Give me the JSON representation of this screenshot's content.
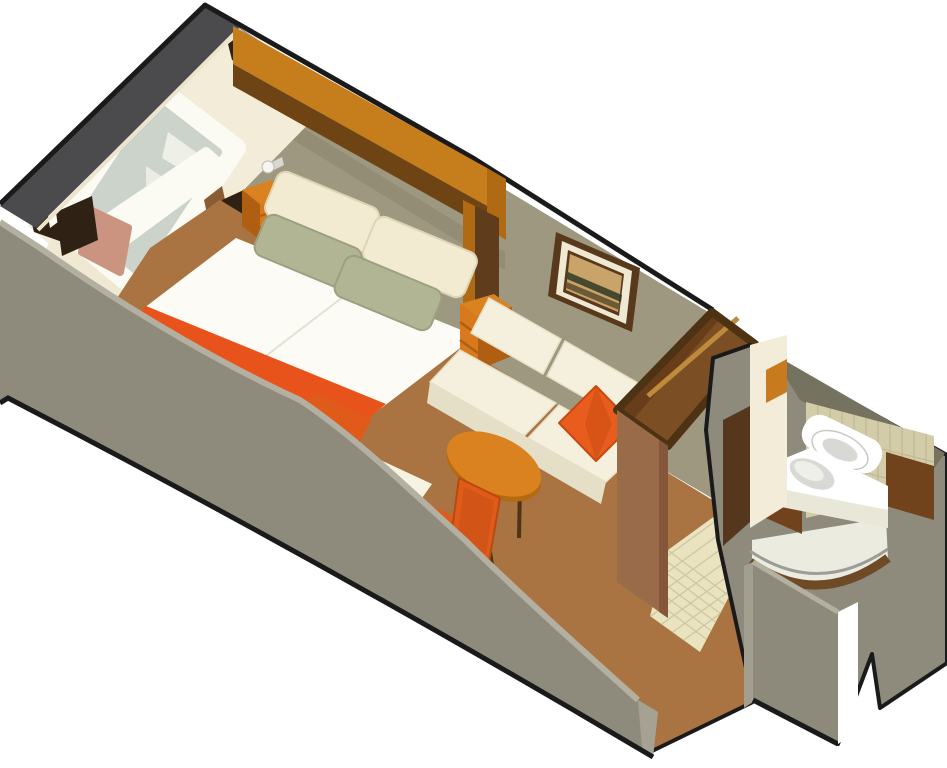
{
  "scene": {
    "type": "isometric-cutaway-floorplan",
    "subject": "Cruise ship oceanview stateroom - isometric cutaway floor plan",
    "areas": [
      "sleeping-area",
      "sitting-area",
      "entry-corridor",
      "bathroom"
    ],
    "objects": [
      "exterior-hull-wall",
      "picture-window",
      "window-curtains",
      "window-seat",
      "headboard-canopy",
      "double-bed",
      "bed-runner",
      "pillows",
      "nightstand-left",
      "nightstand-right",
      "wall-lamp",
      "framed-picture",
      "sofa",
      "throw-pillow",
      "coffee-table",
      "desk",
      "desk-stool",
      "chair",
      "wardrobe",
      "bathroom-sink",
      "toilet",
      "shower",
      "vanity",
      "bathroom-door",
      "tile-floor",
      "carpet",
      "cutaway-front-wall"
    ]
  },
  "palette": {
    "bg": "#ffffff",
    "outline": "#1a1a1a",
    "hullDark": "#4b4b4d",
    "wallOlive": "#9d987f",
    "wallOliveShadow": "#8a8570",
    "swooshGray": "#8e8b7c",
    "swooshLight": "#b3b0a1",
    "swooshEnd": "#a5a294",
    "creamWall": "#f2ecd9",
    "creamTrim": "#ece4cc",
    "canopyOrange": "#c67d1c",
    "canopyShelf": "#6f4415",
    "postOrange": "#b06a14",
    "postDark": "#5f3c1c",
    "woodTrim": "#8a5c33",
    "curtain": "#2f2214",
    "windowFrame": "#fbfaf3",
    "glass": "#ccd3cb",
    "glassShape": "#eef0e8",
    "seatPink": "#cb9480",
    "sillCream": "#efe8d2",
    "bedBase": "#4a2d12",
    "duvet": "#fcfbf5",
    "duvetShade": "#e9e6d8",
    "runnerOrange": "#e7531b",
    "runnerDark": "#c44312",
    "pillowCream": "#f2ebd1",
    "pillowCreamShade": "#ded5b5",
    "pillowSage": "#b2b594",
    "pillowSageShade": "#9ba080",
    "sofaCream": "#f5f0dd",
    "sofaShade": "#e6dfc7",
    "sofaDark": "#d7cfb2",
    "throwOrange": "#e85d1d",
    "throwDark": "#c8490f",
    "nightOrange": "#d8791d",
    "nightShade": "#b05f12",
    "tableOrange": "#d9821f",
    "tableRim": "#b36a10",
    "legDark": "#4d3318",
    "chairOrange": "#e05a1a",
    "chairDark": "#b84a10",
    "deskWhite": "#f7f3e3",
    "deskShade": "#e8e2cc",
    "carpet": "#a97441",
    "tile": "#eae3c0",
    "tileGrid": "#cfc79f",
    "wardrobeRim": "#4e3214",
    "wardrobeInterior": "#7c4e24",
    "wardrobeInteriorDark": "#653c19",
    "wardrobeFront": "#9a6b48",
    "wardrobeFrontDark": "#84563a",
    "rail": "#c08a3c",
    "bathGrayDark": "#75725f",
    "bathTile": "#d3cca8",
    "bathTileGrid": "#bdb58e",
    "vanityBrown": "#71431d",
    "fixtureWhite": "#ffffff",
    "fixtureShade": "#d8d8d4",
    "showerFloor": "#ecebdf",
    "showerCurve": "#6e4a26",
    "showerRail": "#9c9c98",
    "bathDoorOrange": "#c87a1e",
    "corridorDark": "#54371c",
    "sliverWhite": "#ffffff",
    "frameDark": "#59391b",
    "frameMat": "#efe9d4",
    "artSky": "#c8a36a",
    "artDark": "#2f3a22",
    "artMid": "#6b5a34",
    "lampWhite": "#f5f5f2",
    "counterFront": "#e9e7d8"
  }
}
